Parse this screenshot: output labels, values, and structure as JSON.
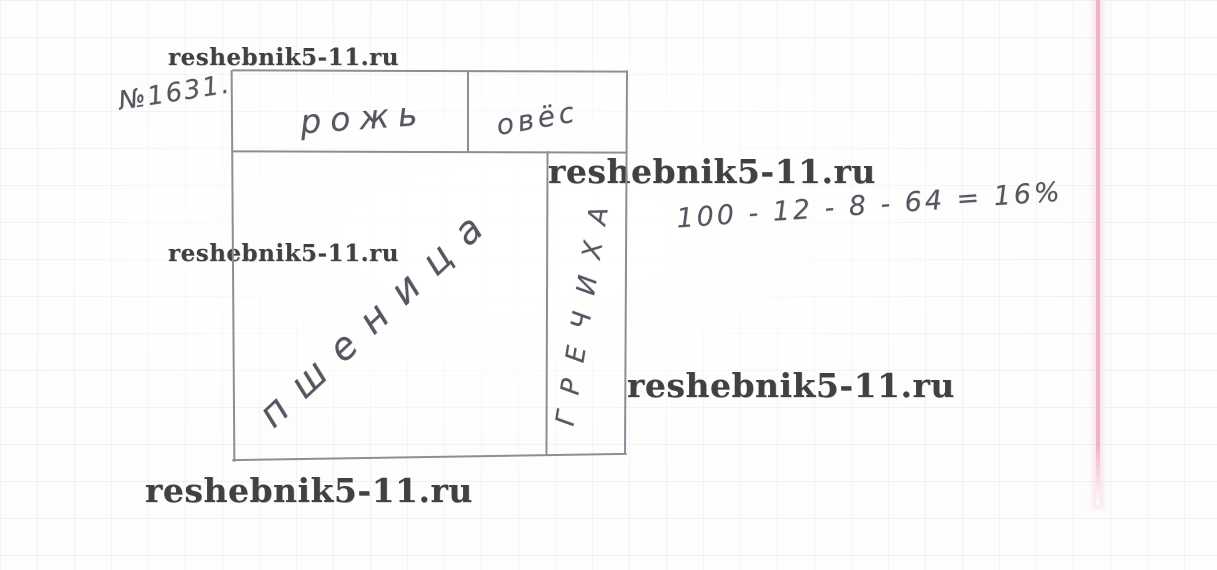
{
  "page": {
    "watermark_text": "reshebnik5-11.ru"
  },
  "problem": {
    "number_label": "№1631.",
    "calculation": "100 - 12 - 8 - 64 = 16%"
  },
  "diagram": {
    "labels": {
      "rye": "рожь",
      "oats": "овёс",
      "wheat": "пшеница",
      "buckwheat": "ГРЕЧИХА"
    }
  },
  "colors": {
    "pencil": "#565660",
    "diagram_line": "#8d8d98",
    "watermark": "#414144",
    "margin_line": "#f3b1c8",
    "grid_line": "#94b6cc",
    "paper": "#fdfdfc"
  }
}
